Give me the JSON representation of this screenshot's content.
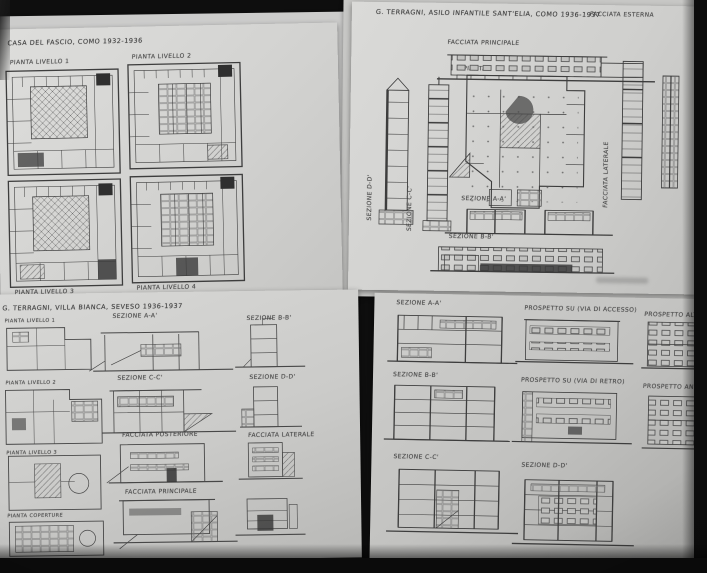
{
  "colors": {
    "paper": "#d6d6d3",
    "ink": "#3d3d3d",
    "background": "#0e0e0e"
  },
  "sheets": {
    "top_left": {
      "title": "CASA DEL FASCIO, COMO 1932-1936",
      "plan_labels": [
        "PIANTA LIVELLO 1",
        "PIANTA LIVELLO 2",
        "PIANTA LIVELLO 3",
        "PIANTA LIVELLO 4"
      ]
    },
    "top_right": {
      "title": "G. TERRAGNI, ASILO INFANTILE SANT'ELIA, COMO 1936-1937",
      "corner_label": "FACCIATA ESTERNA",
      "labels": {
        "facade_front": "FACCIATA PRINCIPALE",
        "plan": "PIANTA",
        "section_d": "SEZIONE D-D'",
        "section_c": "SEZIONE C-C'",
        "facade_side": "FACCIATA LATERALE",
        "section_a": "SEZIONE A-A'",
        "section_b": "SEZIONE B-B'"
      }
    },
    "bottom_left": {
      "title": "G. TERRAGNI, VILLA BIANCA, SEVESO 1936-1937",
      "plan_labels": [
        "PIANTA LIVELLO 1",
        "PIANTA LIVELLO 2",
        "PIANTA LIVELLO 3",
        "PIANTA COPERTURE"
      ],
      "labels": {
        "section_a": "SEZIONE A-A'",
        "section_b": "SEZIONE B-B'",
        "section_c": "SEZIONE C-C'",
        "section_d": "SEZIONE D-D'",
        "facade_rear": "FACCIATA POSTERIORE",
        "facade_side": "FACCIATA LATERALE",
        "facade_front": "FACCIATA PRINCIPALE"
      }
    },
    "bottom_right": {
      "labels": {
        "section_a": "SEZIONE A-A'",
        "elev_access": "PROSPETTO SU (VIA DI ACCESSO)",
        "elev_alt": "PROSPETTO ALTERNATIVO",
        "section_b": "SEZIONE B-B'",
        "elev_rear": "PROSPETTO SU (VIA DI RETRO)",
        "elev_corner": "PROSPETTO ANGOLARE",
        "section_c": "SEZIONE C-C'",
        "section_d": "SEZIONE D-D'"
      }
    }
  }
}
